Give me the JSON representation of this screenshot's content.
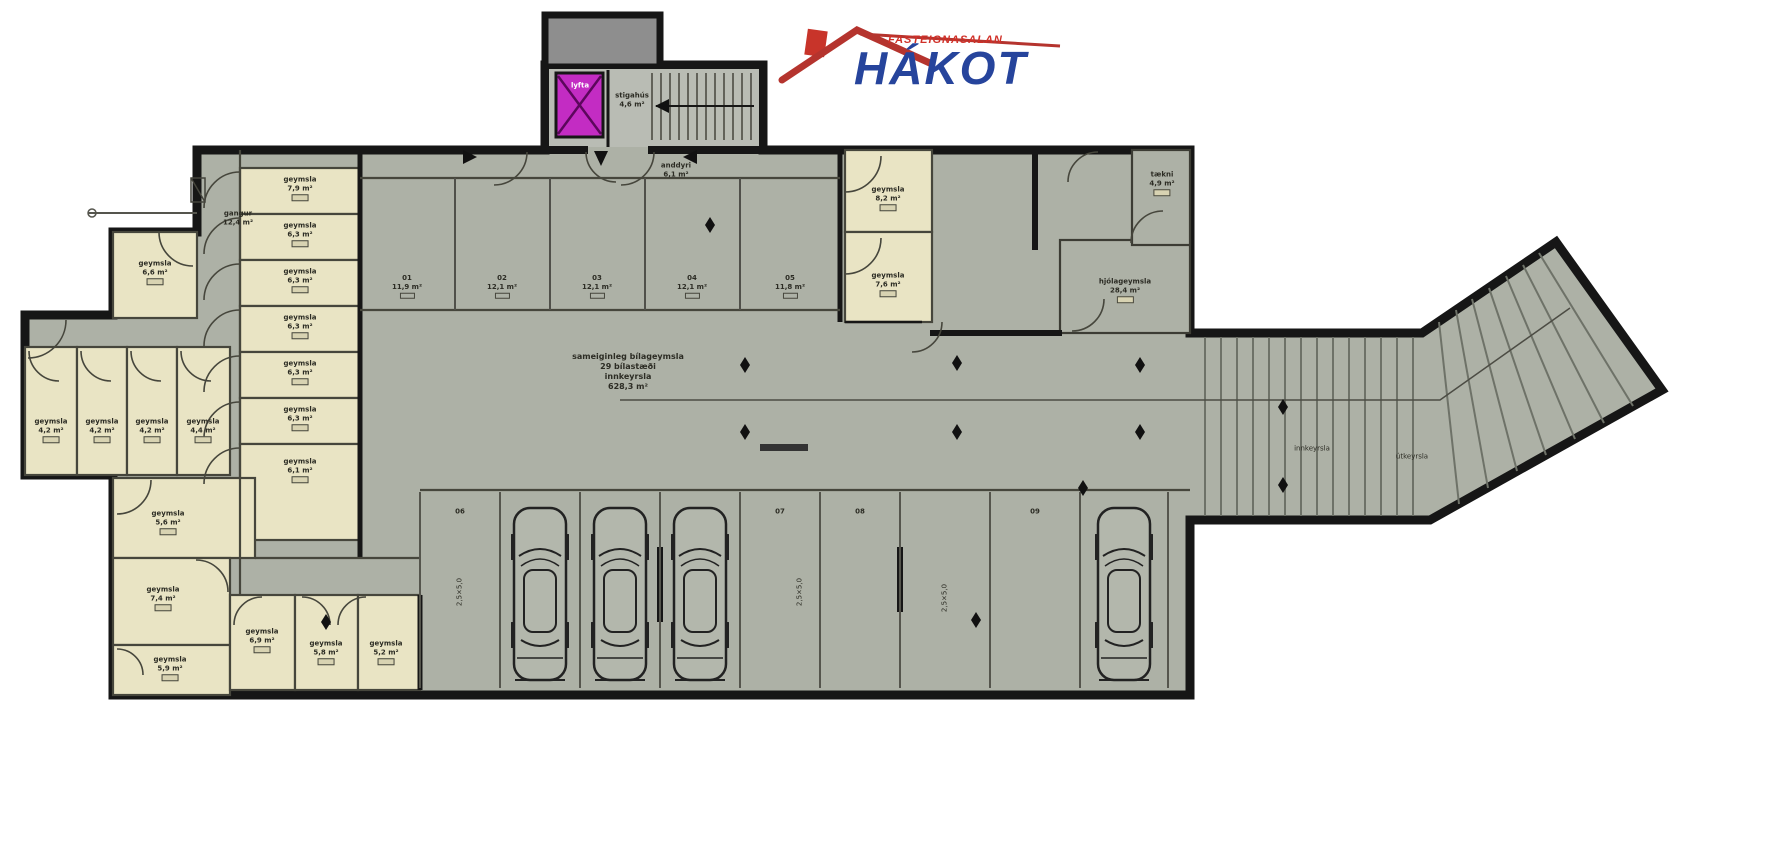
{
  "logo": {
    "tagline": "FASTEIGNASALAN",
    "brand": "HÁKOT",
    "roof_color": "#b5342e",
    "brand_color": "#26449c"
  },
  "palette": {
    "wall": "#161616",
    "garage_floor": "#adb1a6",
    "stair_floor": "#b9bcb4",
    "storage_room": "#e9e4c4",
    "vestibule_box": "#8e8e8e",
    "elevator": "#c32cc3"
  },
  "plan": {
    "labels": [
      {
        "x": 300,
        "y": 188,
        "cls": "room",
        "lines": [
          "geymsla",
          "7,9 m²"
        ]
      },
      {
        "x": 300,
        "y": 234,
        "cls": "room",
        "lines": [
          "geymsla",
          "6,3 m²"
        ]
      },
      {
        "x": 300,
        "y": 280,
        "cls": "room",
        "lines": [
          "geymsla",
          "6,3 m²"
        ]
      },
      {
        "x": 300,
        "y": 326,
        "cls": "room",
        "lines": [
          "geymsla",
          "6,3 m²"
        ]
      },
      {
        "x": 300,
        "y": 372,
        "cls": "room",
        "lines": [
          "geymsla",
          "6,3 m²"
        ]
      },
      {
        "x": 300,
        "y": 418,
        "cls": "room",
        "lines": [
          "geymsla",
          "6,3 m²"
        ]
      },
      {
        "x": 300,
        "y": 470,
        "cls": "room",
        "lines": [
          "geymsla",
          "6,1 m²"
        ]
      },
      {
        "x": 155,
        "y": 272,
        "cls": "room",
        "lines": [
          "geymsla",
          "6,6 m²"
        ]
      },
      {
        "x": 51,
        "y": 430,
        "cls": "room",
        "lines": [
          "geymsla",
          "4,2 m²"
        ]
      },
      {
        "x": 102,
        "y": 430,
        "cls": "room",
        "lines": [
          "geymsla",
          "4,2 m²"
        ]
      },
      {
        "x": 152,
        "y": 430,
        "cls": "room",
        "lines": [
          "geymsla",
          "4,2 m²"
        ]
      },
      {
        "x": 203,
        "y": 430,
        "cls": "room",
        "lines": [
          "geymsla",
          "4,4 m²"
        ]
      },
      {
        "x": 168,
        "y": 522,
        "cls": "room",
        "lines": [
          "geymsla",
          "5,6 m²"
        ]
      },
      {
        "x": 163,
        "y": 598,
        "cls": "room",
        "lines": [
          "geymsla",
          "7,4 m²"
        ]
      },
      {
        "x": 170,
        "y": 668,
        "cls": "room",
        "lines": [
          "geymsla",
          "5,9 m²"
        ]
      },
      {
        "x": 262,
        "y": 640,
        "cls": "room",
        "lines": [
          "geymsla",
          "6,9 m²"
        ]
      },
      {
        "x": 326,
        "y": 652,
        "cls": "room",
        "lines": [
          "geymsla",
          "5,8 m²"
        ]
      },
      {
        "x": 386,
        "y": 652,
        "cls": "room",
        "lines": [
          "geymsla",
          "5,2 m²"
        ]
      },
      {
        "x": 888,
        "y": 198,
        "cls": "room",
        "lines": [
          "geymsla",
          "8,2 m²"
        ]
      },
      {
        "x": 888,
        "y": 284,
        "cls": "room",
        "lines": [
          "geymsla",
          "7,6 m²"
        ]
      },
      {
        "x": 1125,
        "y": 290,
        "cls": "room",
        "lines": [
          "hjólageymsla",
          "28,4 m²"
        ]
      },
      {
        "x": 1162,
        "y": 183,
        "cls": "room",
        "lines": [
          "tækni",
          "4,9 m²"
        ]
      },
      {
        "x": 238,
        "y": 218,
        "cls": "small",
        "lines": [
          "gangur",
          "12,4 m²"
        ]
      },
      {
        "x": 676,
        "y": 170,
        "cls": "small",
        "lines": [
          "anddyri",
          "6,1 m²"
        ]
      },
      {
        "x": 632,
        "y": 100,
        "cls": "small",
        "lines": [
          "stigahús",
          "4,6 m²"
        ]
      },
      {
        "x": 580,
        "y": 86,
        "cls": "elev",
        "lines": [
          "lyfta"
        ]
      },
      {
        "x": 628,
        "y": 372,
        "cls": "center",
        "lines": [
          "sameiginleg bílageymsla",
          "29 bílastæði",
          "innkeyrsla",
          "628,3 m²"
        ]
      },
      {
        "x": 1312,
        "y": 449,
        "cls": "ramp",
        "lines": [
          "innkeyrsla"
        ]
      },
      {
        "x": 1412,
        "y": 457,
        "cls": "ramp",
        "lines": [
          "útkeyrsla"
        ]
      },
      {
        "x": 407,
        "y": 286,
        "cls": "unit",
        "lines": [
          "01",
          "11,9 m²"
        ]
      },
      {
        "x": 502,
        "y": 286,
        "cls": "unit",
        "lines": [
          "02",
          "12,1 m²"
        ]
      },
      {
        "x": 597,
        "y": 286,
        "cls": "unit",
        "lines": [
          "03",
          "12,1 m²"
        ]
      },
      {
        "x": 692,
        "y": 286,
        "cls": "unit",
        "lines": [
          "04",
          "12,1 m²"
        ]
      },
      {
        "x": 790,
        "y": 286,
        "cls": "unit",
        "lines": [
          "05",
          "11,8 m²"
        ]
      },
      {
        "x": 460,
        "y": 512,
        "cls": "spot",
        "lines": [
          "06"
        ]
      },
      {
        "x": 780,
        "y": 512,
        "cls": "spot",
        "lines": [
          "07"
        ]
      },
      {
        "x": 860,
        "y": 512,
        "cls": "spot",
        "lines": [
          "08"
        ]
      },
      {
        "x": 1035,
        "y": 512,
        "cls": "spot",
        "lines": [
          "09"
        ]
      },
      {
        "x": 460,
        "y": 592,
        "cls": "vdim",
        "lines": [
          "2,5×5,0"
        ]
      },
      {
        "x": 800,
        "y": 592,
        "cls": "vdim",
        "lines": [
          "2,5×5,0"
        ]
      },
      {
        "x": 945,
        "y": 598,
        "cls": "vdim",
        "lines": [
          "2,5×5,0"
        ]
      }
    ],
    "cars": [
      {
        "x": 511,
        "y": 500
      },
      {
        "x": 591,
        "y": 500
      },
      {
        "x": 671,
        "y": 500
      },
      {
        "x": 1095,
        "y": 500
      }
    ],
    "markers": [
      {
        "x": 710,
        "y": 225
      },
      {
        "x": 745,
        "y": 365
      },
      {
        "x": 745,
        "y": 432
      },
      {
        "x": 957,
        "y": 363
      },
      {
        "x": 957,
        "y": 432
      },
      {
        "x": 1140,
        "y": 365
      },
      {
        "x": 1140,
        "y": 432
      },
      {
        "x": 1283,
        "y": 407
      },
      {
        "x": 1283,
        "y": 485
      },
      {
        "x": 326,
        "y": 622
      },
      {
        "x": 976,
        "y": 620
      },
      {
        "x": 1083,
        "y": 488
      }
    ],
    "arrows": [
      {
        "x": 470,
        "y": 157,
        "dir": "right"
      },
      {
        "x": 690,
        "y": 157,
        "dir": "left"
      },
      {
        "x": 601,
        "y": 158,
        "dir": "down"
      },
      {
        "x": 662,
        "y": 106,
        "dir": "left"
      }
    ]
  }
}
